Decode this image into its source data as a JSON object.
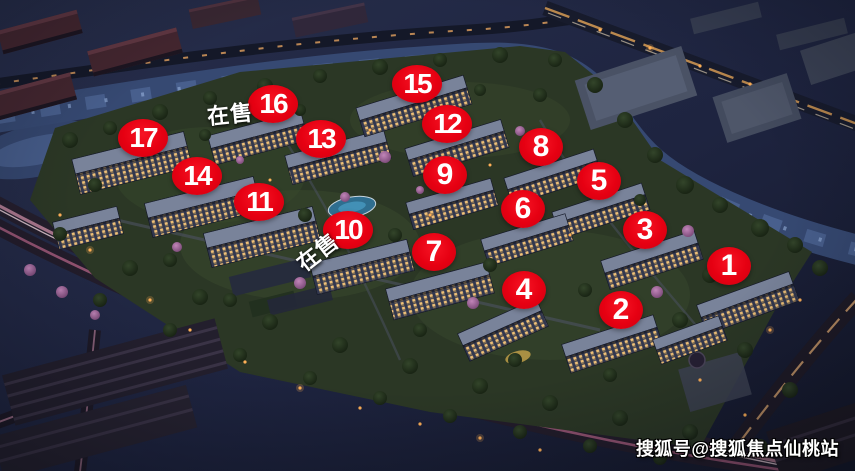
{
  "map": {
    "markers": [
      {
        "label": "1",
        "x": 729,
        "y": 266
      },
      {
        "label": "2",
        "x": 621,
        "y": 310
      },
      {
        "label": "3",
        "x": 645,
        "y": 230
      },
      {
        "label": "4",
        "x": 524,
        "y": 290
      },
      {
        "label": "5",
        "x": 599,
        "y": 181
      },
      {
        "label": "6",
        "x": 523,
        "y": 209
      },
      {
        "label": "7",
        "x": 434,
        "y": 252
      },
      {
        "label": "8",
        "x": 541,
        "y": 147
      },
      {
        "label": "9",
        "x": 445,
        "y": 175
      },
      {
        "label": "10",
        "x": 348,
        "y": 230
      },
      {
        "label": "11",
        "x": 259,
        "y": 202
      },
      {
        "label": "12",
        "x": 447,
        "y": 124
      },
      {
        "label": "13",
        "x": 321,
        "y": 139
      },
      {
        "label": "14",
        "x": 197,
        "y": 176
      },
      {
        "label": "15",
        "x": 417,
        "y": 84
      },
      {
        "label": "16",
        "x": 273,
        "y": 104
      },
      {
        "label": "17",
        "x": 143,
        "y": 138
      }
    ],
    "sale_labels": [
      {
        "text": "在售",
        "x": 230,
        "y": 113,
        "rotation": -6
      },
      {
        "text": "在售",
        "x": 317,
        "y": 251,
        "rotation": -38
      }
    ],
    "colors": {
      "badge": "#e60012",
      "badge_text": "#ffffff",
      "label_text": "#ffffff",
      "watermark_text": "#ffffff"
    }
  },
  "watermark": {
    "text": "搜狐号@搜狐焦点仙桃站"
  }
}
